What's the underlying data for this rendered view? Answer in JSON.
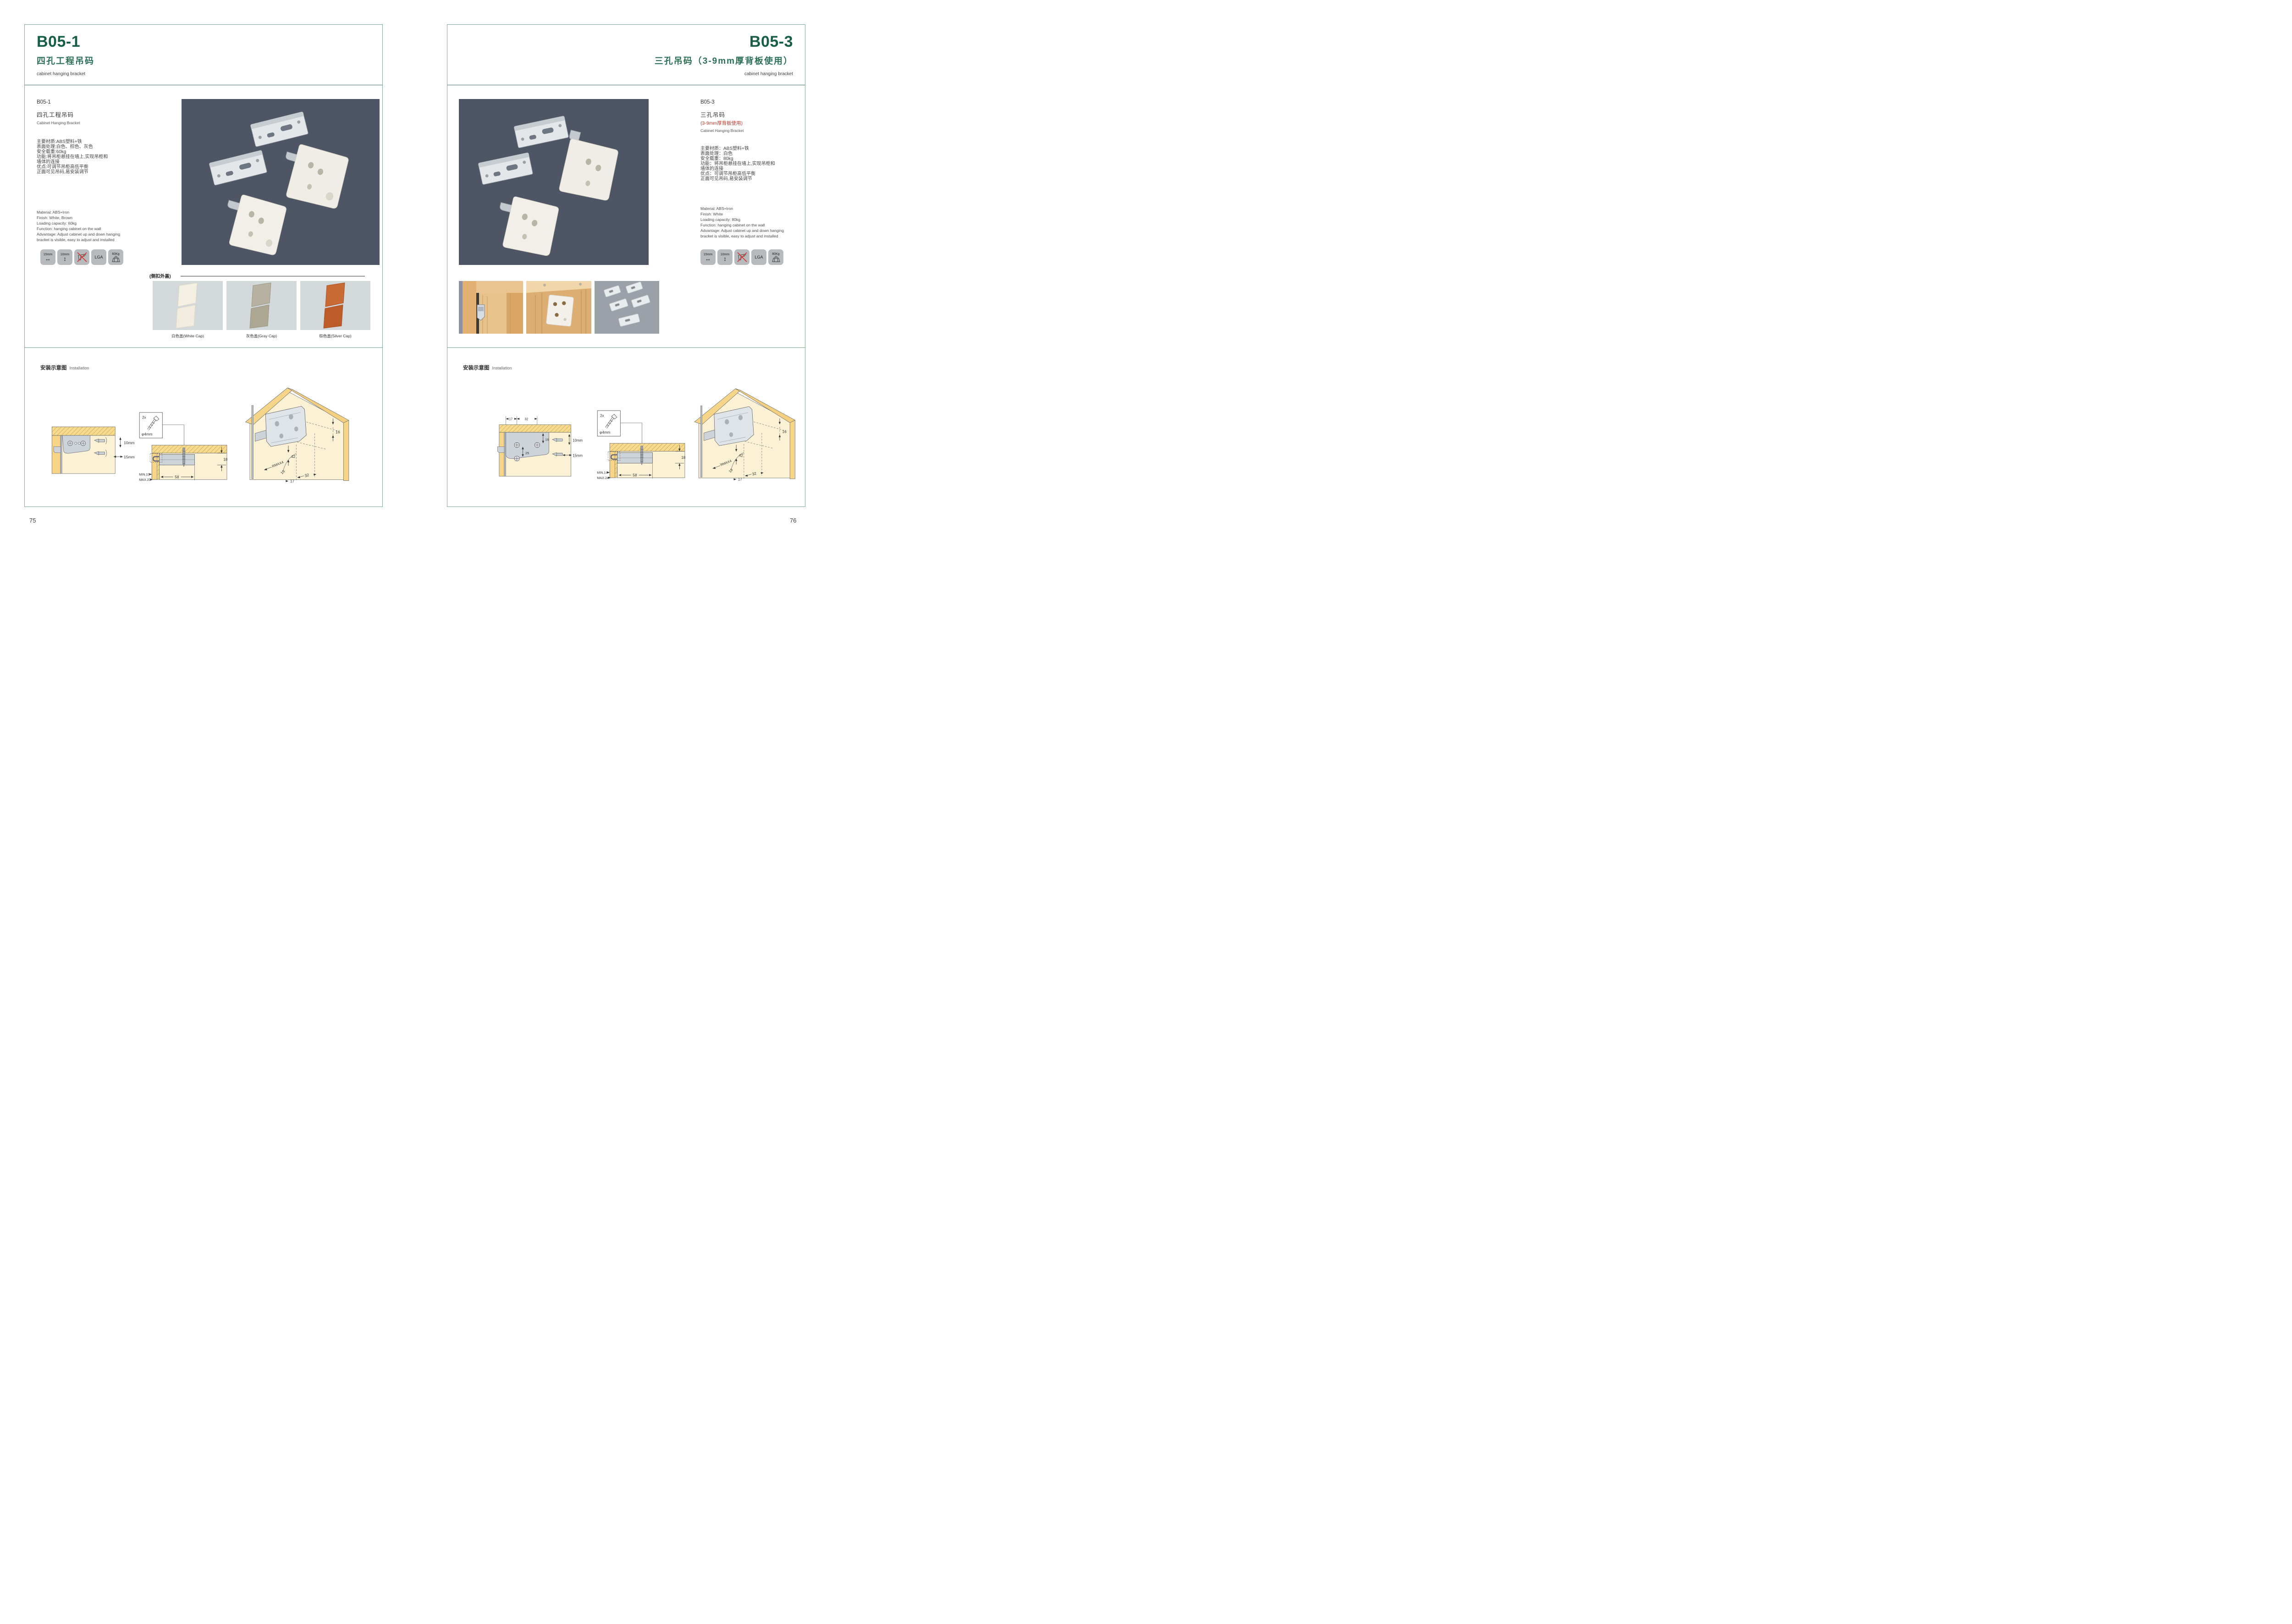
{
  "colors": {
    "brand_green": "#175e44",
    "subtitle_green": "#2c7156",
    "accent_red": "#c13a2c",
    "page_border_green": "#7fa991",
    "photo_background": "#4e5565",
    "icon_tile_gray": "#b6babd",
    "cap_panel_gray": "#d3d8da",
    "diagram_wood_yellow": "#f6d488",
    "diagram_panel_cream": "#fbf2d6",
    "diagram_bracket_gray": "#ccd3d9",
    "cap_white": "#f4f0e3",
    "cap_gray": "#b6b1a1",
    "cap_brown": "#c76a33"
  },
  "page_left": {
    "page_number": "75",
    "header": {
      "code": "B05-1",
      "title_cn": "四孔工程吊码",
      "title_en": "cabinet hanging bracket"
    },
    "product": {
      "code": "B05-1",
      "name_cn": "四孔工程吊码",
      "name_en": "Cabinet Hanging Bracket",
      "specs_cn": [
        "主要材质:ABS塑料+铁",
        "表面处理:白色、棕色、灰色",
        "安全载重:60kg",
        "功能:将吊柜悬挂在墙上,实现吊柜和",
        "墙体的连接",
        "优点:可调节吊柜高低平衡",
        "正面可见吊码,易安装调节"
      ],
      "specs_en": [
        "Material: ABS+Iron",
        "Finish: White, Brown",
        "Loading capacity: 60kg",
        "Function: hanging cabinet on the wall",
        "Advantage: Adjust cabinet up and down hanging",
        "bracket is visible, easy to adjust and installed"
      ]
    },
    "icons": [
      {
        "name": "horizontal-adjust-icon",
        "label": "15mm",
        "glyph": "↔"
      },
      {
        "name": "vertical-adjust-icon",
        "label": "10mm",
        "glyph": "↕"
      },
      {
        "name": "no-drill-icon",
        "label": ""
      },
      {
        "name": "lga-certified-icon",
        "label": "LGA"
      },
      {
        "name": "load-weight-icon",
        "label": "60Kg"
      }
    ],
    "caps": {
      "label": "(侧扣外盖)",
      "items": [
        {
          "label": "白色盖(White Cap)"
        },
        {
          "label": "灰色盖(Gray Cap)"
        },
        {
          "label": "棕色盖(Silver Cap)"
        }
      ]
    },
    "install": {
      "title_cn": "安装示意图",
      "title_en": "Installation",
      "d1": {
        "vertical": "10mm",
        "horizontal": "15mm"
      },
      "d2": {
        "qty": "2x",
        "dia": "φ4mm",
        "thickness": "18",
        "min": "MIN.10",
        "max": "MAX.23",
        "depth": "58"
      },
      "d3": {
        "top": "16",
        "height": "42",
        "radius": "RMAX4",
        "edge": "16",
        "offset": "17",
        "pitch": "32"
      }
    }
  },
  "page_right": {
    "page_number": "76",
    "header": {
      "code": "B05-3",
      "title_cn": "三孔吊码（3-9mm厚背板使用）",
      "title_en": "cabinet hanging bracket"
    },
    "product": {
      "code": "B05-3",
      "name_cn": "三孔吊码",
      "name_note": "(3-9mm厚背板使用)",
      "name_en": "Cabinet Hanging Bracket",
      "specs_cn": [
        "主要材质：ABS塑料+铁",
        "表面处理：白色",
        "安全载重：80kg",
        "功能：将吊柜悬挂在墙上,实现吊柜和",
        "墙体的连接",
        "优点：可调节吊柜高低平衡",
        "正面可见吊码,易安装调节"
      ],
      "specs_en": [
        "Material: ABS+Iron",
        "Finish: White",
        "Loading capacity: 80kg",
        "Function: hanging cabinet on the wall",
        "Advantage: Adjust cabinet up and down hanging",
        "bracket is visible, easy to adjust and installed"
      ]
    },
    "icons": [
      {
        "name": "horizontal-adjust-icon",
        "label": "15mm",
        "glyph": "↔"
      },
      {
        "name": "vertical-adjust-icon",
        "label": "10mm",
        "glyph": "↕"
      },
      {
        "name": "no-drill-icon",
        "label": ""
      },
      {
        "name": "lga-certified-icon",
        "label": "LGA"
      },
      {
        "name": "load-weight-icon",
        "label": "80Kg"
      }
    ],
    "install": {
      "title_cn": "安装示意图",
      "title_en": "Installation",
      "d1": {
        "offset": "17",
        "pitch": "32",
        "top": "16",
        "spacing": "25",
        "vertical": "10mm",
        "horizontal": "15mm"
      },
      "d2": {
        "qty": "2x",
        "dia": "φ4mm",
        "thickness": "18",
        "min": "MIN.14",
        "max": "MAX.24",
        "depth": "58"
      },
      "d3": {
        "top": "16",
        "height": "42",
        "radius": "RMAX4",
        "edge": "18",
        "offset": "17",
        "pitch": "32"
      }
    }
  }
}
